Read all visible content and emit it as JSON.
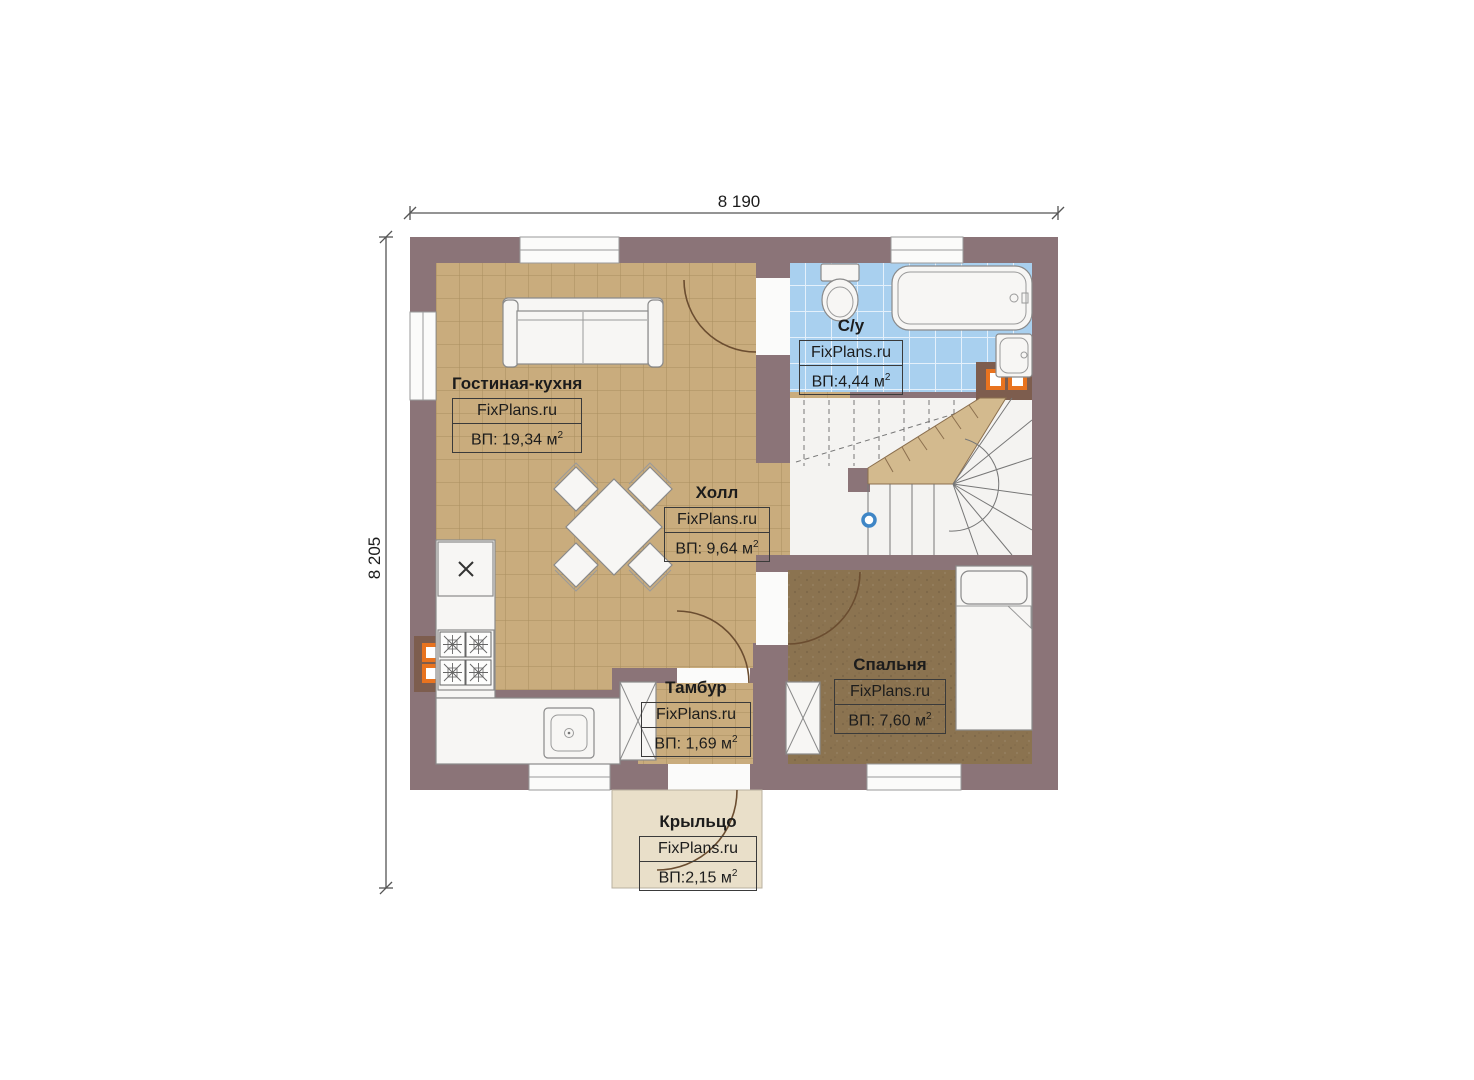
{
  "title": "Floor plan",
  "dimensions": {
    "width_label": "8 190",
    "height_label": "8 205"
  },
  "rooms": [
    {
      "id": "living",
      "name": "Гостиная-кухня",
      "brand": "FixPlans.ru",
      "area": "ВП: 19,34 м",
      "area_sup": "2"
    },
    {
      "id": "bathroom",
      "name": "С/у",
      "brand": "FixPlans.ru",
      "area": "ВП:4,44 м",
      "area_sup": "2"
    },
    {
      "id": "hall",
      "name": "Холл",
      "brand": "FixPlans.ru",
      "area": "ВП: 9,64 м",
      "area_sup": "2"
    },
    {
      "id": "bedroom",
      "name": "Спальня",
      "brand": "FixPlans.ru",
      "area": "ВП: 7,60 м",
      "area_sup": "2"
    },
    {
      "id": "vestibule",
      "name": "Тамбур",
      "brand": "FixPlans.ru",
      "area": "ВП: 1,69 м",
      "area_sup": "2"
    },
    {
      "id": "porch",
      "name": "Крыльцо",
      "brand": "FixPlans.ru",
      "area": "ВП:2,15 м",
      "area_sup": "2"
    }
  ],
  "colors": {
    "wall": "#8b7478",
    "tileFloor": "#c9ac7d",
    "tileGrout": "#a98e5f",
    "bathTile": "#a9d0ef",
    "bathGrout": "#e4f0fb",
    "bedroomFloor": "#8b7350",
    "porchFloor": "#e9dfc9",
    "stairWood": "#d3ba8e",
    "accentOrange": "#e8731f",
    "markerBlue": "#3f86c6"
  }
}
